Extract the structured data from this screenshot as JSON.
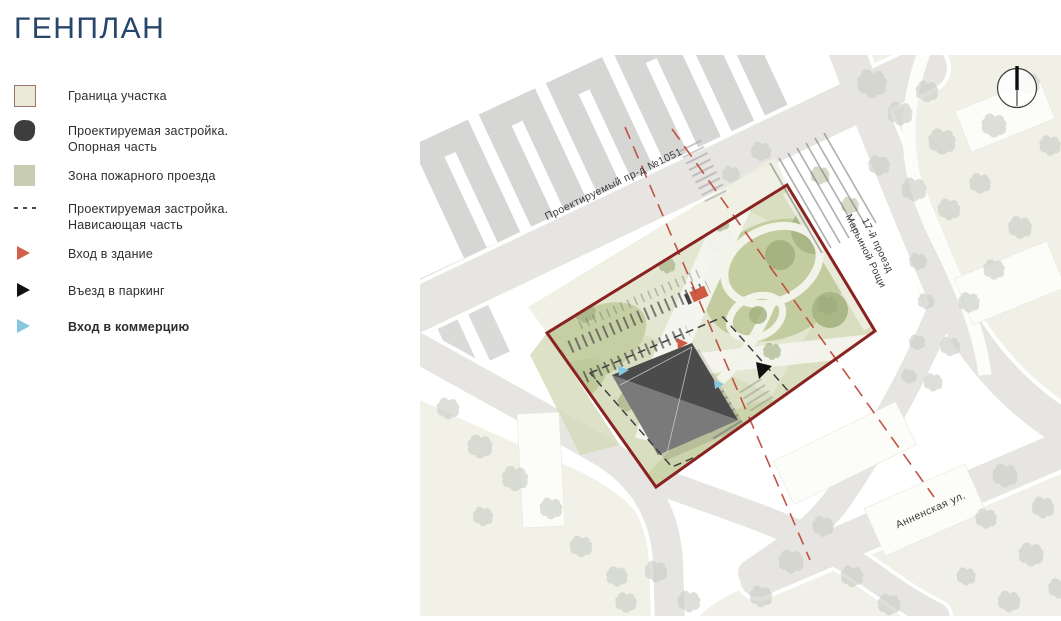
{
  "title": "ГЕНПЛАН",
  "legend": {
    "items": [
      {
        "id": "site-boundary",
        "label": "Граница участка",
        "label2": ""
      },
      {
        "id": "proposed-building-base",
        "label": "Проектируемая застройка.",
        "label2": "Опорная часть"
      },
      {
        "id": "fire-lane",
        "label": "Зона пожарного проезда",
        "label2": ""
      },
      {
        "id": "proposed-building-overhang",
        "label": "Проектируемая застройка.",
        "label2": "Нависающая часть"
      },
      {
        "id": "building-entrance",
        "label": "Вход в здание",
        "label2": ""
      },
      {
        "id": "parking-entrance",
        "label": "Въезд в паркинг",
        "label2": ""
      },
      {
        "id": "commercial-entrance",
        "label": "Вход в коммерцию",
        "label2": ""
      }
    ]
  },
  "map": {
    "street_labels": {
      "projected_drive": "Проектируемый пр-д №1051",
      "proezd_17_line1": "17-й проезд",
      "proezd_17_line2": "Марьиной Рощи",
      "annenskaya": "Анненская ул."
    },
    "compass": "north-arrow",
    "colors": {
      "site_boundary": "#8b2222",
      "setback_dashed": "#bf4a3c",
      "site_green": "#dadec1",
      "fire_lane": "#c8ccb3",
      "building_dark": "#4b4b4b",
      "entrance_building": "#cf5a44",
      "entrance_parking": "#111111",
      "entrance_commercial": "#85c6e3"
    }
  }
}
